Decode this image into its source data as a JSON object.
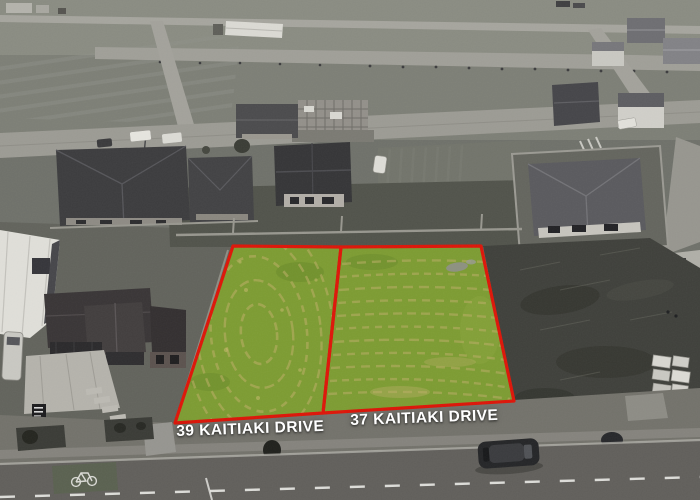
{
  "labels": {
    "lot_left": "39 KAITIAKI DRIVE",
    "lot_right": "37 KAITIAKI DRIVE"
  },
  "palette": {
    "boundary_red": "#de1508",
    "grass_green": "#7d9c32",
    "grass_streak": "#b5ac62",
    "label_text": "#ffffff",
    "road_asphalt": "#615f5b",
    "berm_gray": "#73726b",
    "dirt_dark": "#3f403b",
    "field_gray": "#7d7f76"
  },
  "icons": {
    "cycle_lane": "bicycle-icon"
  }
}
